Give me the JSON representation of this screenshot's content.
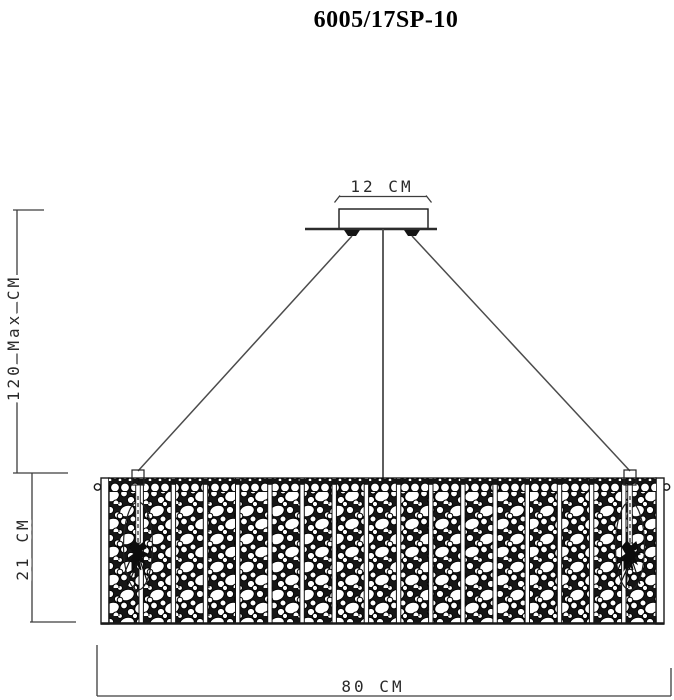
{
  "title": "6005/17SP-10",
  "labels": {
    "canopy_width": "12 CM",
    "max_drop": "120 Max CM",
    "body_height": "21 CM",
    "body_width": "80 CM"
  },
  "values": {
    "canopy_width_cm": 12,
    "max_drop_cm": 120,
    "body_height_cm": 21,
    "body_width_cm": 80
  },
  "fixture": {
    "panel_count": 17,
    "cable_count": 3,
    "hanger_count": 2
  },
  "colors": {
    "background": "#ffffff",
    "line": "#3d3d3d",
    "dark_fill": "#141414",
    "text": "#2a2a2a",
    "title_text": "#000000"
  }
}
